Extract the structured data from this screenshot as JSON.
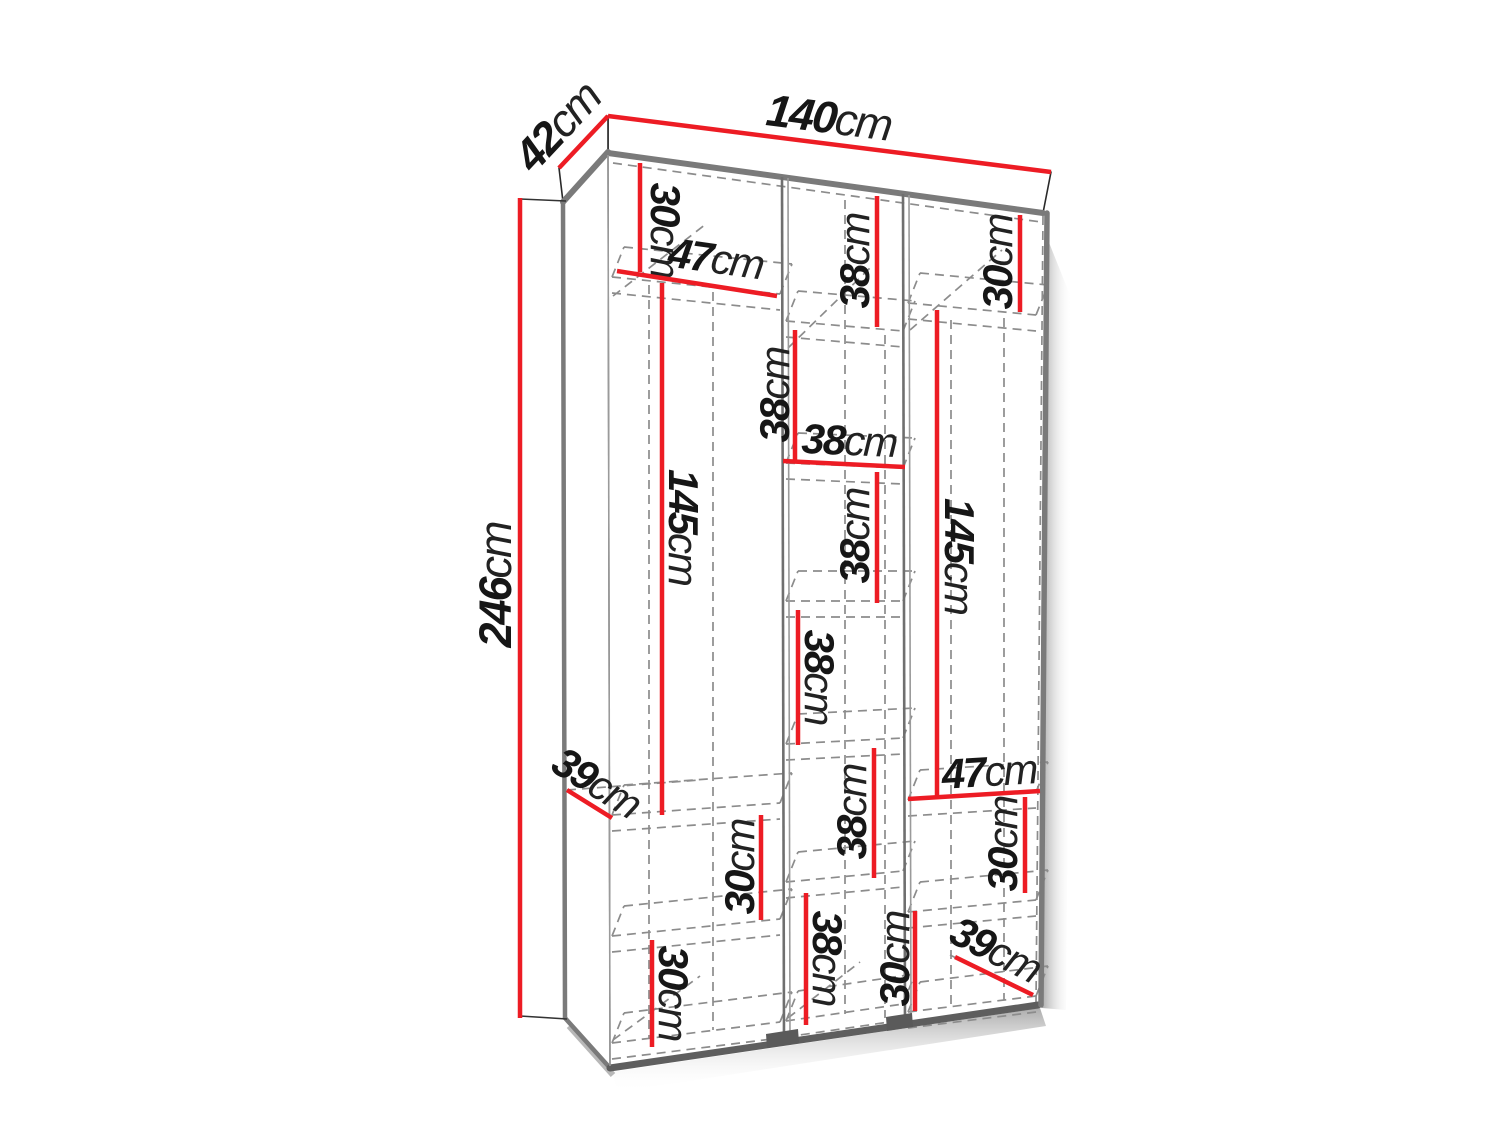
{
  "diagram": {
    "type": "furniture-dimension-diagram",
    "subject": "three-door wardrobe with internal shelving",
    "unit": "cm",
    "overall": {
      "width": "140",
      "depth": "42",
      "height": "246"
    }
  },
  "colors": {
    "dimension_red": "#ed1c24",
    "ink": "#161616",
    "unit_ink": "#222222",
    "edge_gray": "#7a7a7a",
    "edge_dark": "#5e5e5e",
    "dash_gray": "#8c8c8c",
    "thin_outline": "#222222",
    "shadow": "#b5b5b5",
    "shadow_light": "#dcdcdc",
    "plinth": "#5a5a5a"
  },
  "dimensions": [
    {
      "id": "overall-width",
      "num": "140",
      "unit": "cm",
      "line": [
        608,
        116,
        1051,
        172
      ],
      "lx": 829,
      "ly": 117,
      "rot": 7.3,
      "size": 45
    },
    {
      "id": "overall-depth",
      "num": "42",
      "unit": "cm",
      "line": [
        559,
        168,
        608,
        116
      ],
      "lx": 557,
      "ly": 126,
      "rot": -47,
      "size": 45
    },
    {
      "id": "overall-height",
      "num": "246",
      "unit": "cm",
      "line": [
        520,
        198,
        520,
        1018
      ],
      "lx": 495,
      "ly": 585,
      "rot": -90,
      "size": 45
    },
    {
      "id": "left-top-section",
      "num": "30",
      "unit": "cm",
      "line": [
        640,
        163,
        640,
        272
      ],
      "lx": 666,
      "ly": 230,
      "rot": 90,
      "size": 42
    },
    {
      "id": "left-shelf-width",
      "num": "47",
      "unit": "cm",
      "line": [
        617,
        271,
        777,
        296
      ],
      "lx": 716,
      "ly": 258,
      "rot": 8,
      "size": 42
    },
    {
      "id": "left-hanging-space",
      "num": "145",
      "unit": "cm",
      "line": [
        662,
        283,
        662,
        815
      ],
      "lx": 684,
      "ly": 527,
      "rot": 90,
      "size": 42
    },
    {
      "id": "left-shelf-depth",
      "num": "39",
      "unit": "cm",
      "line": [
        567,
        790,
        612,
        818
      ],
      "lx": 597,
      "ly": 782,
      "rot": 32,
      "size": 42
    },
    {
      "id": "left-mid-section",
      "num": "30",
      "unit": "cm",
      "line": [
        761,
        815,
        761,
        920
      ],
      "lx": 739,
      "ly": 867,
      "rot": -90,
      "size": 42
    },
    {
      "id": "left-bottom-section",
      "num": "30",
      "unit": "cm",
      "line": [
        652,
        940,
        652,
        1047
      ],
      "lx": 674,
      "ly": 993,
      "rot": 90,
      "size": 42
    },
    {
      "id": "mid-section-1",
      "num": "38",
      "unit": "cm",
      "line": [
        877,
        196,
        877,
        327
      ],
      "lx": 854,
      "ly": 261,
      "rot": -90,
      "size": 42
    },
    {
      "id": "mid-section-2",
      "num": "38",
      "unit": "cm",
      "line": [
        795,
        330,
        795,
        462
      ],
      "lx": 774,
      "ly": 395,
      "rot": -90,
      "size": 42
    },
    {
      "id": "mid-shelf-width",
      "num": "38",
      "unit": "cm",
      "line": [
        783,
        461,
        905,
        467
      ],
      "lx": 849,
      "ly": 440,
      "rot": 2.5,
      "size": 42
    },
    {
      "id": "mid-section-3",
      "num": "38",
      "unit": "cm",
      "line": [
        877,
        472,
        877,
        603
      ],
      "lx": 854,
      "ly": 536,
      "rot": -90,
      "size": 42
    },
    {
      "id": "mid-section-4",
      "num": "38",
      "unit": "cm",
      "line": [
        798,
        610,
        798,
        745
      ],
      "lx": 820,
      "ly": 677,
      "rot": 90,
      "size": 42
    },
    {
      "id": "mid-section-5",
      "num": "38",
      "unit": "cm",
      "line": [
        874,
        748,
        874,
        878
      ],
      "lx": 851,
      "ly": 812,
      "rot": -90,
      "size": 42
    },
    {
      "id": "mid-bottom-section",
      "num": "38",
      "unit": "cm",
      "line": [
        806,
        893,
        806,
        1025
      ],
      "lx": 828,
      "ly": 958,
      "rot": 90,
      "size": 42
    },
    {
      "id": "right-top-section",
      "num": "30",
      "unit": "cm",
      "line": [
        1020,
        215,
        1020,
        312
      ],
      "lx": 997,
      "ly": 262,
      "rot": -90,
      "size": 42
    },
    {
      "id": "right-hanging-space",
      "num": "145",
      "unit": "cm",
      "line": [
        937,
        310,
        937,
        798
      ],
      "lx": 960,
      "ly": 556,
      "rot": 90,
      "size": 42
    },
    {
      "id": "right-shelf-width",
      "num": "47",
      "unit": "cm",
      "line": [
        908,
        799,
        1040,
        791
      ],
      "lx": 989,
      "ly": 771,
      "rot": -3.5,
      "size": 42
    },
    {
      "id": "right-mid-section",
      "num": "30",
      "unit": "cm",
      "line": [
        1025,
        797,
        1025,
        893
      ],
      "lx": 1002,
      "ly": 844,
      "rot": -90,
      "size": 42
    },
    {
      "id": "right-bottom-section",
      "num": "30",
      "unit": "cm",
      "line": [
        915,
        911,
        915,
        1011
      ],
      "lx": 894,
      "ly": 959,
      "rot": -90,
      "size": 42
    },
    {
      "id": "right-floor-depth",
      "num": "39",
      "unit": "cm",
      "line": [
        955,
        957,
        1033,
        995
      ],
      "lx": 996,
      "ly": 949,
      "rot": 27,
      "size": 42
    }
  ]
}
